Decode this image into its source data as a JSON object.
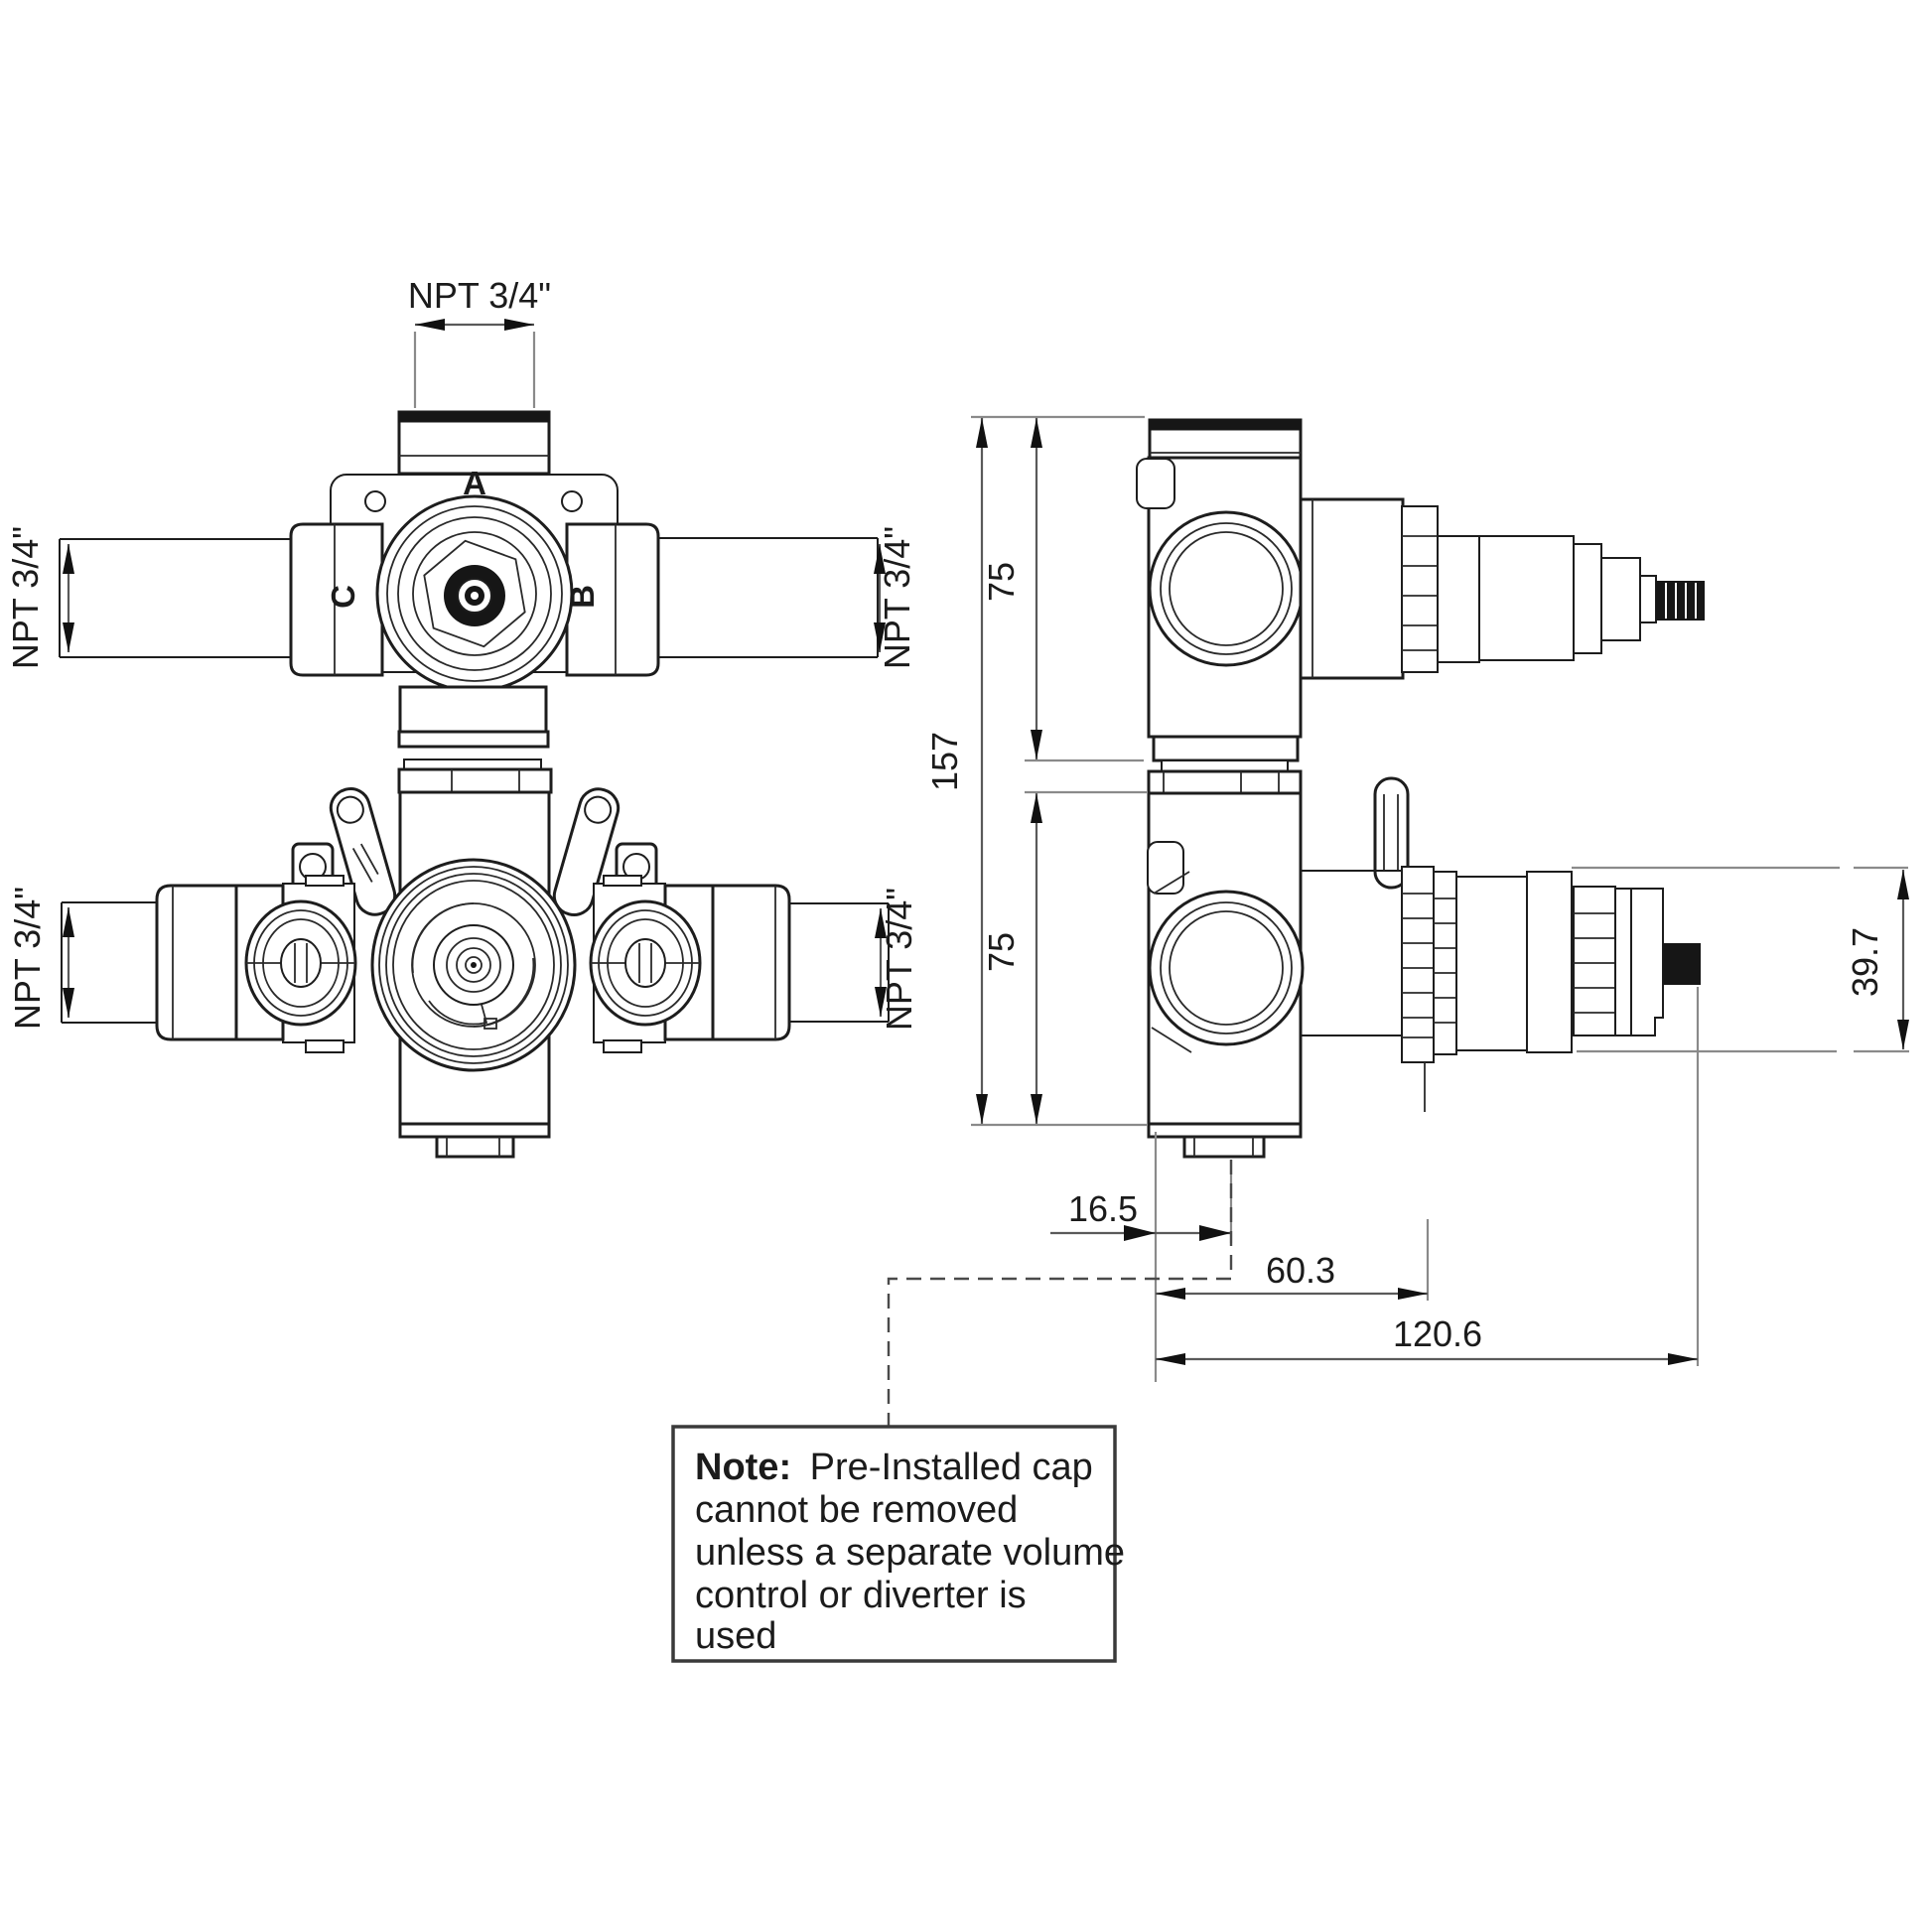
{
  "drawing": {
    "background": "#ffffff",
    "line_color": "#1d1d1d",
    "dim_color": "#5a5a5a",
    "stem_color": "#161616"
  },
  "front_view": {
    "port_top_label": "A",
    "port_left_label": "C",
    "port_right_label": "B",
    "npt_top": "NPT 3/4\"",
    "npt_left_upper": "NPT 3/4\"",
    "npt_right_upper": "NPT 3/4\"",
    "npt_left_lower": "NPT 3/4\"",
    "npt_right_lower": "NPT 3/4\""
  },
  "side_view": {
    "overall_height": "157",
    "upper_port_height": "75",
    "lower_port_height": "75",
    "cartridge_height": "39.7",
    "outlet_offset": "16.5",
    "body_depth": "60.3",
    "overall_depth": "120.6"
  },
  "note": {
    "label": "Note:",
    "text_line_1": "Pre-Installed cap",
    "text_line_2": "cannot be removed",
    "text_line_3": "unless a separate volume",
    "text_line_4": "control or diverter is",
    "text_line_5": "used"
  }
}
